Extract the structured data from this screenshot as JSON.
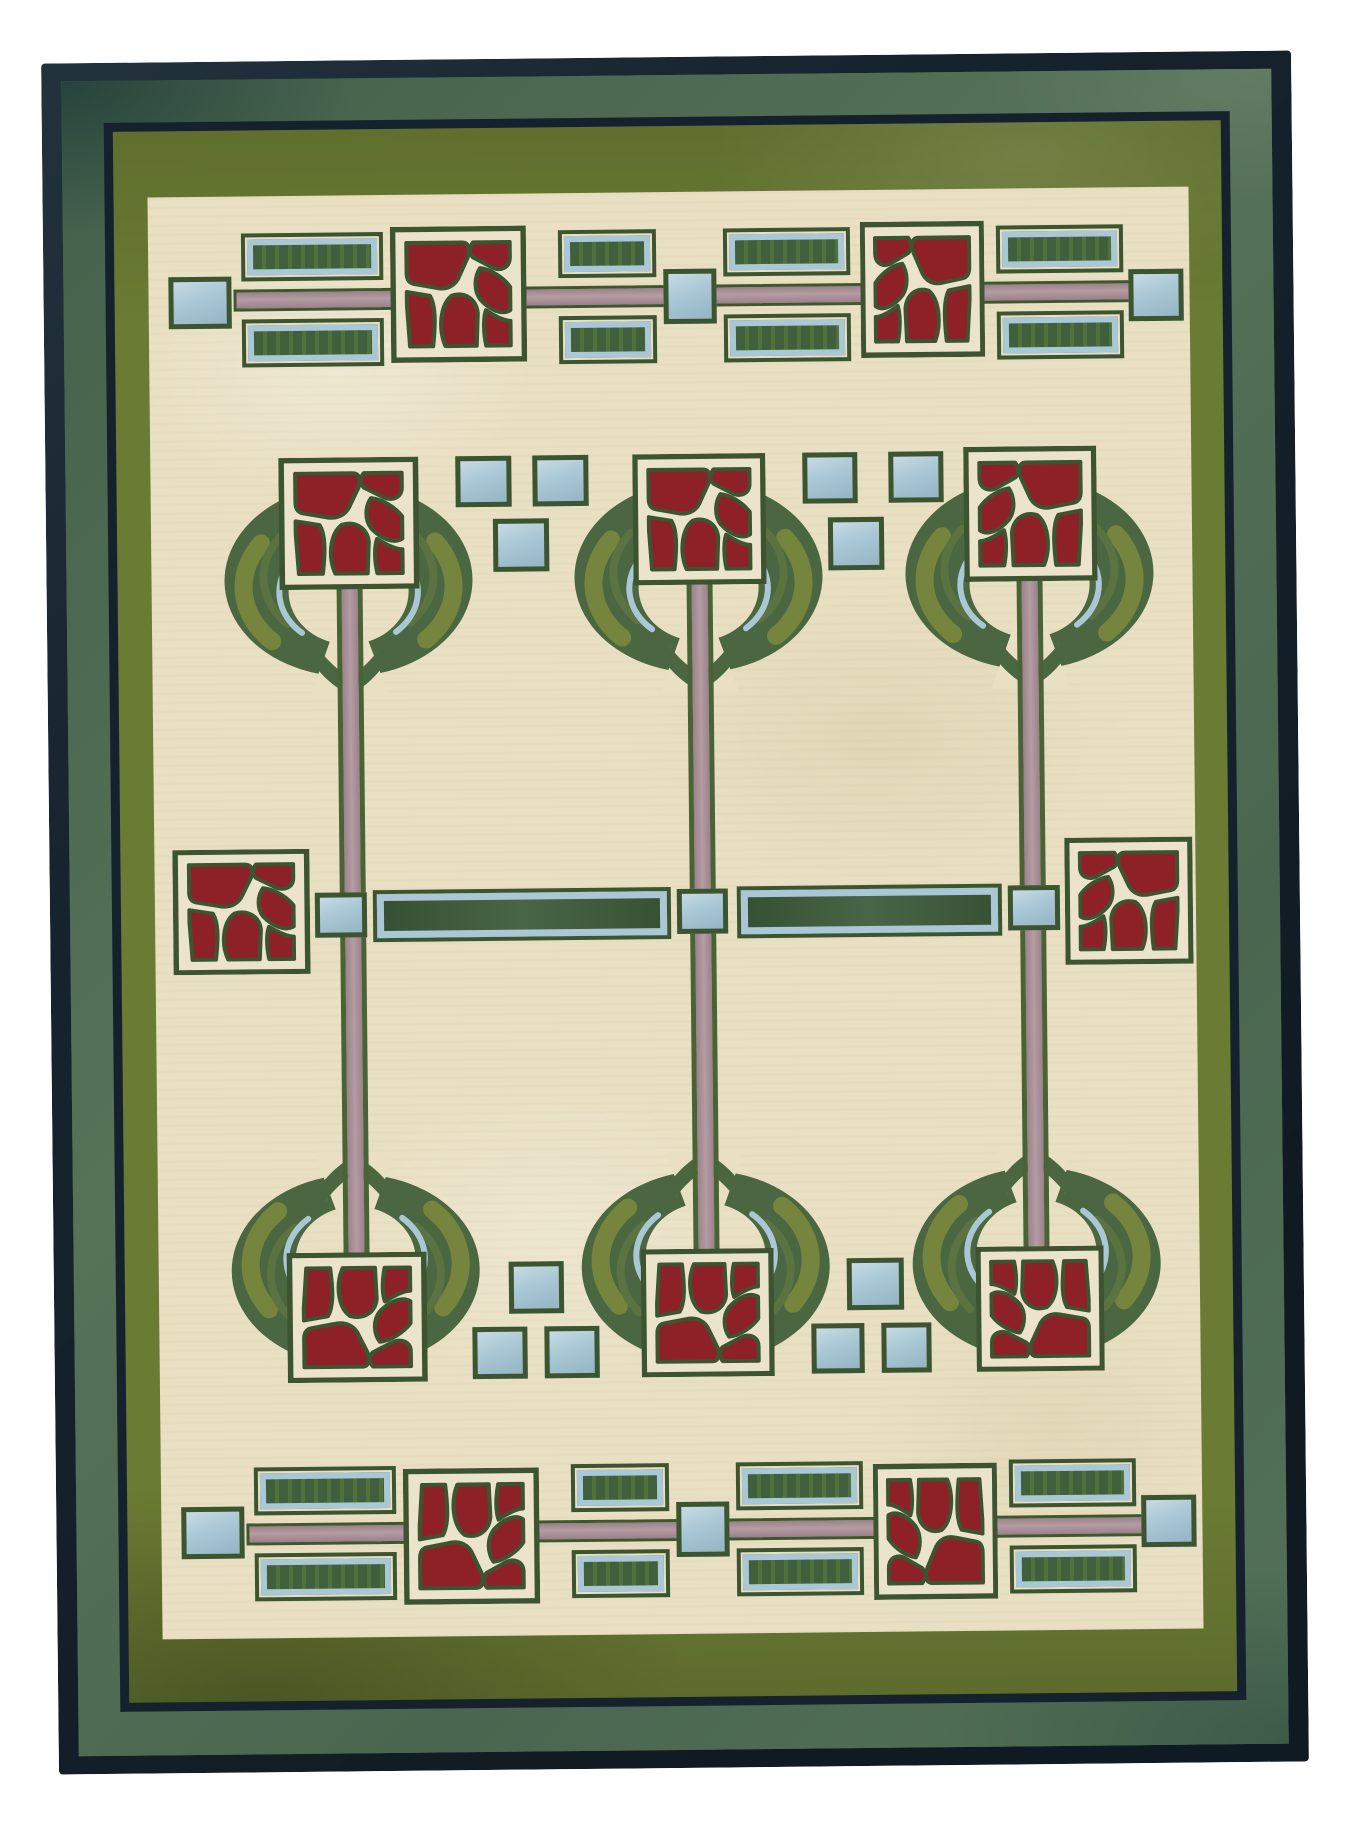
{
  "scene": {
    "description": "Photograph of a hand-knotted Arts and Crafts style wool rug with stylized Mackintosh rose trees: cream field, olive and sage green borders with navy guard stripes, three rose-topped wreath trees with mauve stems, red rose squares, dark green panelled rectangles and pale blue squares, fringed top and bottom edges."
  },
  "palette": {
    "page_bg": "#ffffff",
    "navy": "#16232e",
    "sage_band": "#4f6b55",
    "olive_band": "#6a7b33",
    "field_cream": "#e9e0c3",
    "cream_inner": "#ece4ca",
    "outline_green": "#3c5530",
    "panel_green": "#41603a",
    "panel_stripe": "#50703e",
    "wreath_green": "#4b6741",
    "olive_streak": "#75853e",
    "olive_streak_dark": "#5a7340",
    "light_blue": "#a9c7d5",
    "mauve": "#aa8f97",
    "rose_red": "#8e2028",
    "fringe": "#d6cdb8"
  },
  "rug": {
    "x": 50,
    "y": 57,
    "width": 1250,
    "height": 1711,
    "rotation_deg": -0.6,
    "borders": {
      "navy_edge": {
        "top": 18,
        "right": 20,
        "bottom": 18,
        "left": 20
      },
      "sage_band": {
        "top": 60,
        "right": 62,
        "bottom": 62,
        "left": 62
      },
      "navy_line": {
        "top": 69,
        "right": 71,
        "bottom": 71,
        "left": 71
      },
      "field_inset": {
        "top": 135,
        "right": 104,
        "bottom": 134,
        "left": 105
      }
    },
    "fringe": {
      "height": 18,
      "top_offset": -18,
      "bottom_offset": -18
    }
  },
  "motifs": {
    "pink_bars": [
      {
        "x": 190,
        "y": 228,
        "w": 900,
        "h": 22
      },
      {
        "x": 190,
        "y": 1462,
        "w": 900,
        "h": 22
      }
    ],
    "green_bars": [
      {
        "x": 323,
        "y": 830,
        "w": 298,
        "h": 52
      },
      {
        "x": 687,
        "y": 830,
        "w": 265,
        "h": 52
      }
    ],
    "stems": [
      {
        "x": 290,
        "y": 522,
        "w": 26,
        "h": 688
      },
      {
        "x": 640,
        "y": 522,
        "w": 26,
        "h": 688
      },
      {
        "x": 970,
        "y": 522,
        "w": 26,
        "h": 688
      }
    ],
    "green_rects": [
      {
        "x": 198,
        "y": 172,
        "w": 142,
        "h": 48
      },
      {
        "x": 198,
        "y": 258,
        "w": 142,
        "h": 48
      },
      {
        "x": 515,
        "y": 172,
        "w": 98,
        "h": 48
      },
      {
        "x": 515,
        "y": 258,
        "w": 98,
        "h": 48
      },
      {
        "x": 680,
        "y": 172,
        "w": 127,
        "h": 48
      },
      {
        "x": 680,
        "y": 258,
        "w": 127,
        "h": 48
      },
      {
        "x": 953,
        "y": 172,
        "w": 127,
        "h": 48
      },
      {
        "x": 953,
        "y": 258,
        "w": 127,
        "h": 48
      },
      {
        "x": 198,
        "y": 1406,
        "w": 142,
        "h": 48
      },
      {
        "x": 198,
        "y": 1492,
        "w": 142,
        "h": 48
      },
      {
        "x": 515,
        "y": 1406,
        "w": 98,
        "h": 48
      },
      {
        "x": 515,
        "y": 1492,
        "w": 98,
        "h": 48
      },
      {
        "x": 680,
        "y": 1406,
        "w": 127,
        "h": 48
      },
      {
        "x": 680,
        "y": 1492,
        "w": 127,
        "h": 48
      },
      {
        "x": 953,
        "y": 1406,
        "w": 127,
        "h": 48
      },
      {
        "x": 953,
        "y": 1492,
        "w": 127,
        "h": 48
      }
    ],
    "blue_squares": [
      {
        "x": 125,
        "y": 215,
        "w": 63,
        "h": 52
      },
      {
        "x": 620,
        "y": 212,
        "w": 53,
        "h": 55
      },
      {
        "x": 1085,
        "y": 217,
        "w": 55,
        "h": 52
      },
      {
        "x": 410,
        "y": 397,
        "w": 56,
        "h": 51
      },
      {
        "x": 487,
        "y": 397,
        "w": 56,
        "h": 51
      },
      {
        "x": 447,
        "y": 460,
        "w": 56,
        "h": 53
      },
      {
        "x": 757,
        "y": 397,
        "w": 55,
        "h": 51
      },
      {
        "x": 843,
        "y": 397,
        "w": 55,
        "h": 51
      },
      {
        "x": 782,
        "y": 462,
        "w": 56,
        "h": 53
      },
      {
        "x": 265,
        "y": 832,
        "w": 52,
        "h": 45
      },
      {
        "x": 627,
        "y": 832,
        "w": 51,
        "h": 45
      },
      {
        "x": 958,
        "y": 832,
        "w": 52,
        "h": 45
      },
      {
        "x": 455,
        "y": 1203,
        "w": 55,
        "h": 52
      },
      {
        "x": 418,
        "y": 1268,
        "w": 55,
        "h": 52
      },
      {
        "x": 490,
        "y": 1268,
        "w": 55,
        "h": 52
      },
      {
        "x": 793,
        "y": 1203,
        "w": 57,
        "h": 52
      },
      {
        "x": 757,
        "y": 1268,
        "w": 53,
        "h": 50
      },
      {
        "x": 827,
        "y": 1268,
        "w": 50,
        "h": 50
      },
      {
        "x": 125,
        "y": 1445,
        "w": 63,
        "h": 52
      },
      {
        "x": 620,
        "y": 1445,
        "w": 53,
        "h": 55
      },
      {
        "x": 1085,
        "y": 1443,
        "w": 55,
        "h": 52
      }
    ],
    "wreaths": [
      {
        "x": 173,
        "y": 420,
        "w": 258,
        "h": 215,
        "open": "down"
      },
      {
        "x": 523,
        "y": 420,
        "w": 258,
        "h": 215,
        "open": "down"
      },
      {
        "x": 854,
        "y": 420,
        "w": 258,
        "h": 215,
        "open": "down"
      },
      {
        "x": 173,
        "y": 1095,
        "w": 258,
        "h": 215,
        "open": "up"
      },
      {
        "x": 523,
        "y": 1095,
        "w": 258,
        "h": 215,
        "open": "up"
      },
      {
        "x": 854,
        "y": 1095,
        "w": 258,
        "h": 215,
        "open": "up"
      }
    ],
    "roses": [
      {
        "x": 347,
        "y": 167,
        "w": 136,
        "h": 136,
        "variant": "normal"
      },
      {
        "x": 817,
        "y": 167,
        "w": 124,
        "h": 136,
        "variant": "mirror"
      },
      {
        "x": 233,
        "y": 397,
        "w": 140,
        "h": 132,
        "variant": "normal"
      },
      {
        "x": 587,
        "y": 397,
        "w": 133,
        "h": 131,
        "variant": "normal"
      },
      {
        "x": 918,
        "y": 393,
        "w": 133,
        "h": 135,
        "variant": "mirror"
      },
      {
        "x": 123,
        "y": 788,
        "w": 137,
        "h": 125,
        "variant": "normal"
      },
      {
        "x": 1015,
        "y": 785,
        "w": 128,
        "h": 127,
        "variant": "mirror"
      },
      {
        "x": 233,
        "y": 1192,
        "w": 140,
        "h": 130,
        "variant": "vflip"
      },
      {
        "x": 587,
        "y": 1192,
        "w": 133,
        "h": 128,
        "variant": "vflip"
      },
      {
        "x": 922,
        "y": 1193,
        "w": 128,
        "h": 125,
        "variant": "rot180"
      },
      {
        "x": 347,
        "y": 1409,
        "w": 136,
        "h": 136,
        "variant": "vflip"
      },
      {
        "x": 817,
        "y": 1409,
        "w": 124,
        "h": 136,
        "variant": "rot180"
      }
    ]
  }
}
